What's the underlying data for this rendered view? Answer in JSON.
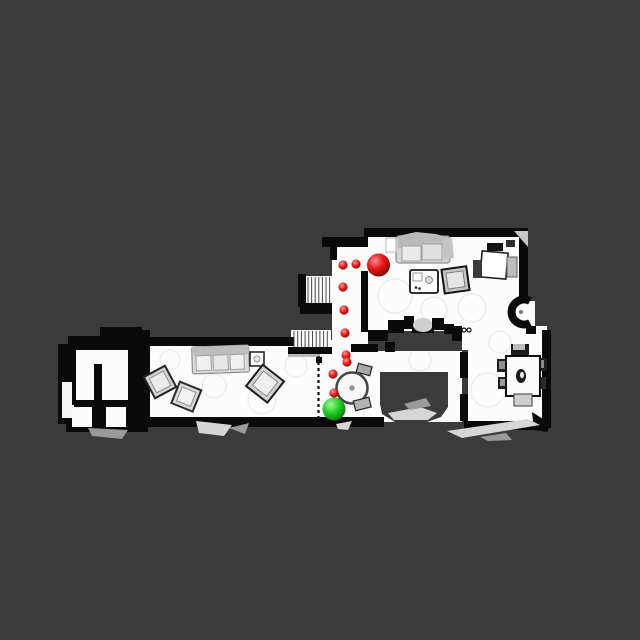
{
  "scene": {
    "title": "top-down-floorplan-navigation-view",
    "background_color": "#3b3b3b",
    "floor_color": "#fcfcfc",
    "wall_color": "#0a0a0a"
  },
  "rooms": [
    {
      "name": "upper-living-room"
    },
    {
      "name": "waypoint-corridor"
    },
    {
      "name": "lower-living-room"
    },
    {
      "name": "hallway-kitchen"
    },
    {
      "name": "dining-room"
    },
    {
      "name": "bathroom-suite"
    },
    {
      "name": "staircase-upper"
    },
    {
      "name": "staircase-lower"
    }
  ],
  "markers": {
    "goal": {
      "x": 378.5,
      "y": 265,
      "r": 11.5,
      "color": "#dd1111"
    },
    "agent": {
      "x": 334,
      "y": 409,
      "r": 11.5,
      "color": "#22cc22"
    },
    "waypoint_color": "#dd1111",
    "waypoint_r": 4.6,
    "waypoints": [
      {
        "x": 343,
        "y": 265
      },
      {
        "x": 356,
        "y": 264
      },
      {
        "x": 343,
        "y": 287
      },
      {
        "x": 344,
        "y": 310
      },
      {
        "x": 345,
        "y": 333
      },
      {
        "x": 346,
        "y": 355
      },
      {
        "x": 347,
        "y": 362
      },
      {
        "x": 333,
        "y": 374
      },
      {
        "x": 334,
        "y": 393
      }
    ]
  }
}
